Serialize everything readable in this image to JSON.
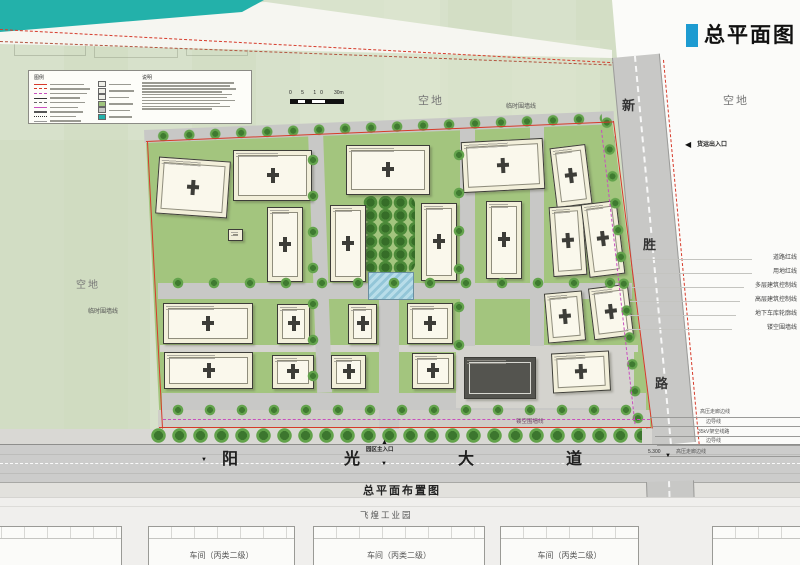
{
  "header": {
    "title": "总平面图"
  },
  "drawing": {
    "caption": "总平面布置图",
    "legend": {
      "title": "图例",
      "notes_title": "说明"
    },
    "scale_bar": {
      "ticks": "0 5 10",
      "end_label": "30m"
    },
    "vacant": "空地",
    "temp_fence": "临时围墙线",
    "hollow_fence": "镂空围墙线",
    "freight_entrance": "货运出入口",
    "main_entrance": "园区主入口",
    "elevation": "5.300",
    "roads": {
      "south": {
        "name": "阳光大道",
        "chars": [
          "阳",
          "光",
          "大",
          "道"
        ]
      },
      "east": {
        "name": "新胜路",
        "chars": [
          "新",
          "胜",
          "路"
        ]
      }
    },
    "boundary_lines": [
      "道路红线",
      "用地红线",
      "多层建筑控制线",
      "高层建筑控制线",
      "地下车库轮廓线",
      "镂空围墙线"
    ],
    "power_lines": [
      "高压走廊边线",
      "边导线",
      "35kV架空线路",
      "边导线",
      "高压走廊边线"
    ],
    "south_parcel": {
      "park_name": "飞煌工业园",
      "workshop_label": "车间（丙类二级）"
    }
  },
  "colors": {
    "accent_blue": "#1d9bd1",
    "water_teal": "#23b1aa",
    "boundary_red": "#d63a2a",
    "fence_magenta": "#c84fbe",
    "field_green": "#d3dec5",
    "lawn_green": "#a3c57e",
    "road_gray": "#c8c8c6"
  }
}
